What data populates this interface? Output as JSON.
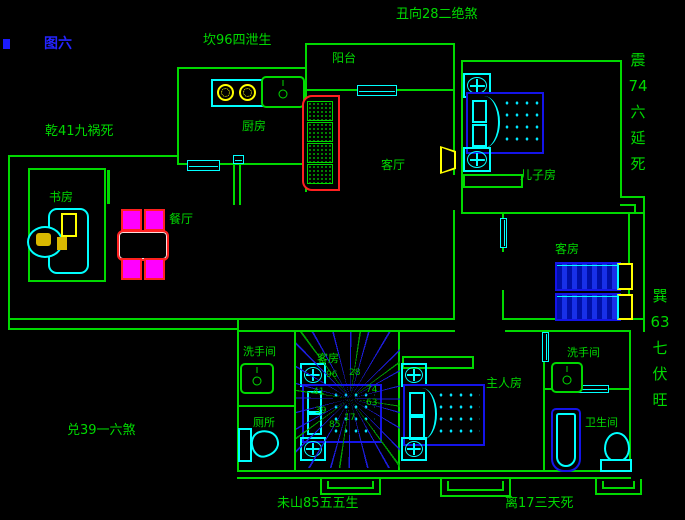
{
  "figure_label": "图六",
  "border_labels": {
    "top_left": "坎96四泄生",
    "top_center": "丑向28二绝煞",
    "left_upper": "乾41九祸死",
    "left_lower": "兑39一六煞",
    "bottom_left": "未山85五五生",
    "bottom_right": "离17三天死",
    "right_upper": [
      "震",
      "74",
      "六",
      "延",
      "死"
    ],
    "right_lower": [
      "巽",
      "63",
      "七",
      "伏",
      "旺"
    ]
  },
  "rooms": {
    "balcony": "阳台",
    "kitchen": "厨房",
    "living_room": "客厅",
    "son_room": "儿子房",
    "guest_room_right": "客房",
    "study": "书房",
    "dining": "餐厅",
    "washroom_left": "洗手间",
    "toilet_left": "厕所",
    "guest_room_center": "客房",
    "master_room": "主人房",
    "washroom_right": "洗手间",
    "bathroom_right": "卫生间"
  },
  "compass": {
    "numbers": {
      "nw": "96",
      "n": "28",
      "e1": "74",
      "e2": "63",
      "s": "17",
      "sw": "85",
      "w2": "39",
      "w1": "41"
    }
  },
  "colors": {
    "background": "#000000",
    "wall_green": "#00d900",
    "line_blue": "#1414e8",
    "cyan": "#00ffff",
    "yellow": "#ffff00",
    "red": "#ff2020",
    "magenta": "#ff00ff",
    "label_blue": "#2424ff"
  }
}
